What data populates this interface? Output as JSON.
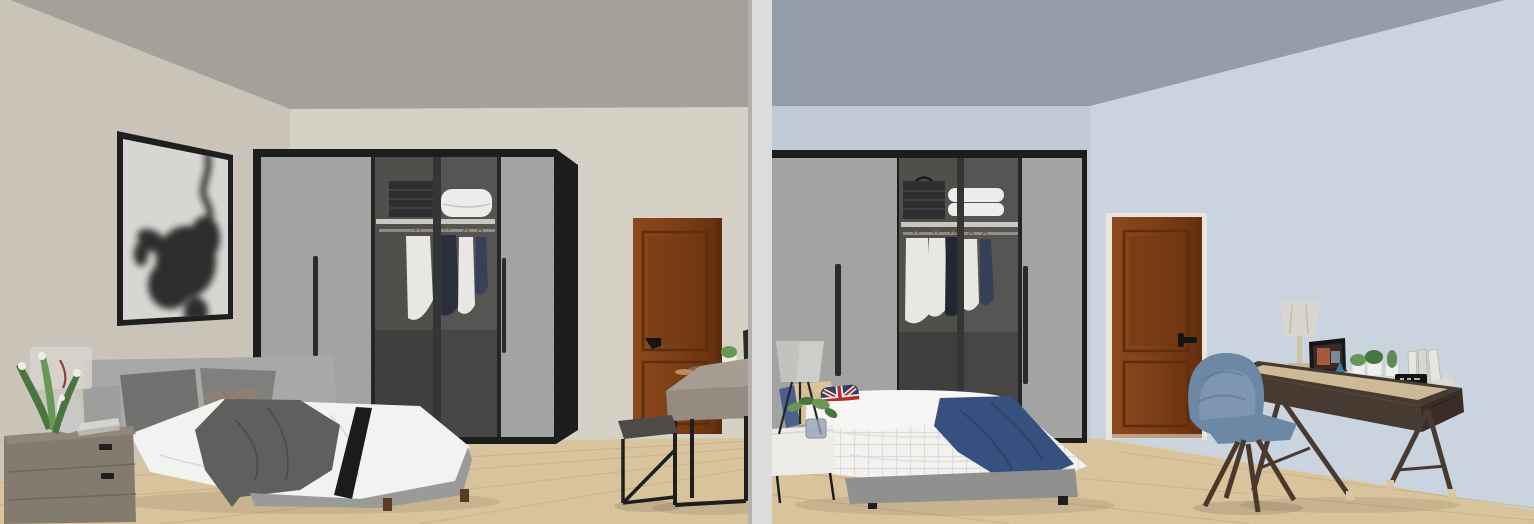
{
  "image": {
    "width": 1534,
    "height": 524,
    "kind": "3d-render-comparison",
    "description": "Two rendered bedroom scenes shown side by side, separated by a light gray vertical divider bar"
  },
  "scenes": {
    "left": {
      "id": "left-bedroom",
      "wall_finish": "warm gray / beige walls, gray ceiling",
      "objects": [
        "framed abstract black-ink artwork on left wall",
        "black-frame sliding wardrobe, open glass section with folded clothes, white duvet and hanging shirts",
        "gray upholstered double bed with two gray pillows, taupe cushion, white duvet, dark gray throw and black band",
        "taupe fabric nightstand with translucent lamp, silver vase, lily plant and books",
        "brown wooden interior door with black handle",
        "gray-wood desk on black metal frame with plant pot, cup, mirror and accessories",
        "black metal stool with dark cushion",
        "light wood plank floor"
      ]
    },
    "right": {
      "id": "right-bedroom",
      "wall_finish": "light blue walls, blue-gray ceiling",
      "objects": [
        "black-frame sliding wardrobe, open glass section with folded clothes, stacked pillows and hanging shirts",
        "double bed with white grid duvet, navy throw, blue / tan / Union-Jack pillows on gray base",
        "white bedside table with tripod lamp and plant in glass vase",
        "brown wooden interior door with black handle",
        "dark walnut writing desk with table lamp, open laptop, potted plants, cactus, books and black clock",
        "blue velvet armchair with splayed wooden legs",
        "light wood plank floor"
      ]
    }
  },
  "divider": {
    "style": "vertical light gray separator bar between the two renders"
  },
  "colors": {
    "lCeiling": "#a4a19a",
    "lWallLeft": "#c9c4b7",
    "lWallBack": "#d6d1c5",
    "rCeiling": "#939ea8",
    "rWallBack": "#bfcad5",
    "rWallRight": "#c9d4df",
    "floorWood": "#d9c39c",
    "floorSeam": "#bfa77e",
    "dividerBar": "#dcdcdc",
    "dividerEdge": "#b4b1ac",
    "frameBlack": "#1f1f1f",
    "canvasWhite": "#d8d6d2",
    "ink": "#141414",
    "wardrobeFrame": "#1d1d1d",
    "wardrobeDoor": "#a3a3a1",
    "doorEdgeDark": "#2b2b2b",
    "interior": "#514f4c",
    "interiorDark": "#413f3d",
    "shelf": "#c9c6c1",
    "rod": "#8d8b88",
    "foldedDark": "#2f2f31",
    "duvetStack": "#ececea",
    "clothWhite": "#e9e7e2",
    "clothNavy": "#232633",
    "clothDenim": "#2e3a52",
    "hanger": "#7a5a38",
    "doorWood": "#7f421b",
    "doorWoodDark": "#5e2d0e",
    "doorTrim": "#e9e5dc",
    "handleBlack": "#141414",
    "bedFrameGray": "#a8a8a6",
    "duvetWhite": "#f2f2f0",
    "throwGray": "#5f5f5d",
    "bandBlack": "#1b1b1b",
    "pillowGray": "#71716f",
    "pillowGray2": "#7f7f7d",
    "pillowTaupe": "#8e7f71",
    "legBrown": "#5a3a24",
    "nightstandTaupe": "#847b6f",
    "nightstandTop": "#90877a",
    "seamDark": "#6e665b",
    "lampShade": "#d9d6d0",
    "lampSilver": "#c8c8c6",
    "stemRed": "#8a4436",
    "plantGreen": "#49763f",
    "plantGreen2": "#699757",
    "flowerWhite": "#efefe8",
    "bookLight": "#d6d4cf",
    "deskGrayTop": "#a79d93",
    "deskGrayWood": "#958b81",
    "metalBlack": "#1e1e1e",
    "stoolSeat": "#4c4b48",
    "mirrorDark": "#2a2a2a",
    "potWhite": "#f0efec",
    "itemBrown": "#7b6a5d",
    "itemTan": "#c08a5f",
    "gridDuvet": "#f3f2f0",
    "gridLine": "#d9d8d4",
    "throwNavy": "#36517f",
    "throwNavyDark": "#2c4066",
    "pillowBlue": "#4a618e",
    "pillowTan": "#d9c49a",
    "ujNavy": "#2c3f6a",
    "ujRed": "#b03227",
    "ujWhite": "#efefef",
    "bedBaseGray": "#90908e",
    "nightstandWhite": "#edebe7",
    "rLampShade": "#cdcdc9",
    "vaseGlass": "#94a3b6",
    "deskWalnut": "#473a31",
    "deskWalnutDark": "#392d25",
    "deskTan": "#ccb995",
    "legTip": "#d8c7a4",
    "chairBlue": "#6d88a5",
    "chairBlueLight": "#7f98b4",
    "woodLeg": "#4a392a",
    "laptopDark": "#161616",
    "screenWarm": "#a55a3a",
    "screenCool": "#7a8a96",
    "paperWhite": "#eceae6",
    "clockBlack": "#121212",
    "cactusGreen": "#5f8b52",
    "bookWhite": "#e8e6e0"
  }
}
